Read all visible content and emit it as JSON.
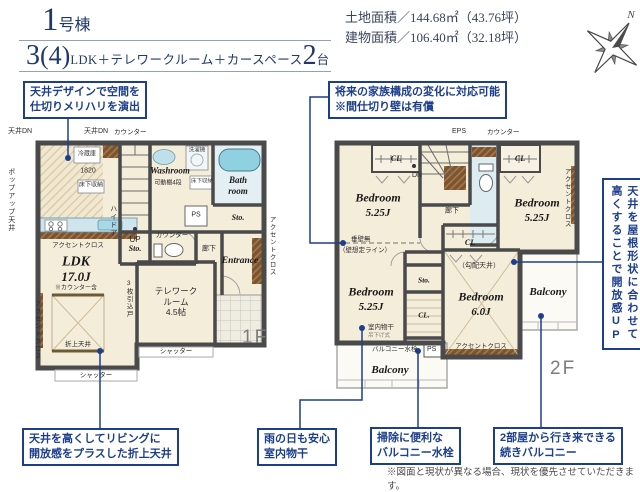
{
  "header": {
    "building_number": "1",
    "building_unit": "号棟",
    "layout_num": "3",
    "layout_paren": "(4)",
    "layout_text": "LDK＋テレワークルーム＋カースペース",
    "layout_count": "2",
    "layout_count_unit": "台",
    "land_area": "土地面積／144.68㎡（43.76坪）",
    "building_area": "建物面積／106.40㎡（32.18坪）",
    "compass_north": "N"
  },
  "callouts": {
    "ceiling_design": "天井デザインで空間を\n仕切りメリハリを演出",
    "family_change": "将来の家族構成の変化に対応可能\n※間仕切り壁は有償",
    "roof_ceiling": "天井を屋根形状に合わせて\n高くすることで開放感UP",
    "coffered": "天井を高くしてリビングに\n開放感をプラスした折上天井",
    "indoor_drying": "雨の日も安心\n室内物干",
    "balcony_faucet": "掃除に便利な\nバルコニー水栓",
    "connected_balcony": "2部屋から行き来できる\n続きバルコニー"
  },
  "note": "※図面と現状が異なる場合、現状を優先させていただきます。",
  "colors": {
    "accent_navy": "#1d3e8c",
    "title_navy": "#21386a",
    "wall_gray": "#4a4a4a",
    "room_cream": "#f4edda",
    "water_blue": "#8fd0e1"
  },
  "floor1": {
    "label": "1F",
    "ldk": "LDK",
    "ldk_size": "17.0J",
    "ldk_note": "※カウンター含",
    "telework": "テレワーク\nルーム\n4.5帖",
    "washroom": "Washroom",
    "bath": "Bath\nroom",
    "entrance": "Entrance",
    "sto1": "Sto.",
    "sto2": "Sto.",
    "hall": "廊下",
    "up": "UP",
    "ps": "PS",
    "ceiling_dn1": "天井DN",
    "ceiling_dn2": "天井DN",
    "counter1": "カウンター",
    "counter2": "カウンター",
    "fridge": "冷蔵庫",
    "dim1820": "1820",
    "floor_storage1": "床下収納",
    "floor_storage2": "床下収納",
    "washer": "洗濯機",
    "shelf": "可動棚4段",
    "high_door": "ハイドア",
    "sliding_door": "3枚引込戸",
    "popup_ceiling": "ポップアップ天井",
    "accent1": "アクセントクロス",
    "accent2": "アクセントクロス",
    "accent3": "アクセントクロス",
    "coffered_label": "折上天井",
    "shutter1": "シャッター",
    "shutter2": "シャッター"
  },
  "floor2": {
    "label": "2F",
    "bedroom1": "Bedroom",
    "bedroom1_size": "5.25J",
    "bedroom2": "Bedroom",
    "bedroom2_size": "5.25J",
    "bedroom3": "Bedroom",
    "bedroom3_size": "5.25J",
    "bedroom4": "Bedroom",
    "bedroom4_size": "6.0J",
    "balcony_left": "Balcony",
    "balcony_right": "Balcony",
    "cl1": "CL",
    "cl2": "CL",
    "cl3": "CL",
    "cl4": "CL.",
    "sto": "Sto.",
    "eps": "EPS",
    "counter": "カウンター",
    "dn": "DN",
    "hall": "廊下",
    "no_wall1": "垂壁無",
    "no_wall2": "（壁想定ライン）",
    "sloped_ceiling": "（勾配天井）",
    "drying": "室内物干",
    "drying_sub": "吊下げ式",
    "faucet": "バルコニー水栓",
    "ps": "PS",
    "accent1": "アクセントクロス",
    "accent2": "アクセントクロス"
  }
}
